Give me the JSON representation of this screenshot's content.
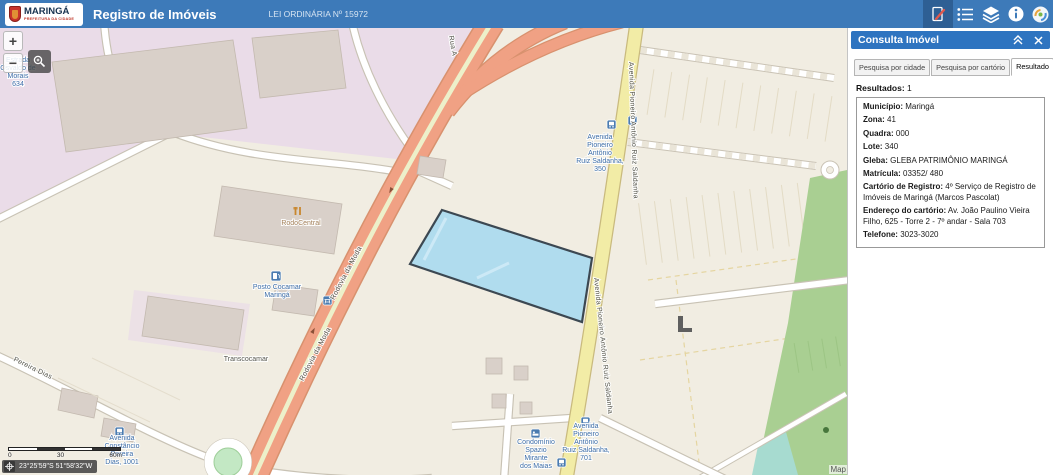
{
  "colors": {
    "header_bg": "#3d7ab9",
    "header_active_bg": "#2e5f94",
    "panel_header_bg": "#2e74c0",
    "map_land": "#f1ede2",
    "industrial_area": "#eadce8",
    "building": "#d9d0c9",
    "road_primary_orange": "#f0a184",
    "road_secondary_yellow": "#f2eca6",
    "green_area": "#a9cf92",
    "water": "#a7dbd0",
    "parcel_fill": "#a5d8f0",
    "parcel_stroke": "#3c4852",
    "poi_label_blue": "#3d6da8"
  },
  "header": {
    "logo": {
      "title": "MARINGÁ",
      "subtitle": "PREFEITURA DA CIDADE"
    },
    "title": "Registro de Imóveis",
    "law": "LEI ORDINÁRIA Nº 15972"
  },
  "panel": {
    "title": "Consulta Imóvel",
    "tabs": [
      {
        "label": "Pesquisa por cidade",
        "active": false
      },
      {
        "label": "Pesquisa por cartório",
        "active": false
      },
      {
        "label": "Resultado",
        "active": true
      }
    ],
    "results_label": "Resultados:",
    "results_count": "1",
    "fields": [
      {
        "label": "Município:",
        "value": "Maringá"
      },
      {
        "label": "Zona:",
        "value": "41"
      },
      {
        "label": "Quadra:",
        "value": "000"
      },
      {
        "label": "Lote:",
        "value": "340"
      },
      {
        "label": "Gleba:",
        "value": "GLEBA PATRIMÔNIO MARINGÁ"
      },
      {
        "label": "Matrícula:",
        "value": "03352/ 480"
      },
      {
        "label": "Cartório de Registro:",
        "value": "4º Serviço de Registro de Imóveis de Maringá (Marcos Pascolat)"
      },
      {
        "label": "Endereço do cartório:",
        "value": "Av. João Paulino Vieira Filho, 625 - Torre 2 - 7º andar - Sala 703"
      },
      {
        "label": "Telefone:",
        "value": "3023-3020"
      }
    ]
  },
  "map": {
    "controls": {
      "zoom_in": "+",
      "zoom_out": "−"
    },
    "scalebar": {
      "start": "0",
      "mid": "30",
      "end": "60m"
    },
    "coordinates": "23°25'59\"S 51°58'32\"W",
    "attribution": "Map",
    "labels": {
      "estrada": [
        "Estrada",
        "Osvaldo de",
        "Morais",
        "634"
      ],
      "rodocentral": "RodoCentral",
      "posto": [
        "Posto Cocamar",
        "Maringá"
      ],
      "transcocamar": "Transcocamar",
      "rodovia_moda": "Rodovia da Moda",
      "pereira_dias": "Pereira Dias",
      "rua_a": "Rua A",
      "av_saldanha": "Avenida Pioneiro Antônio Ruiz Saldanha",
      "av_350": [
        "Avenida",
        "Pioneiro",
        "Antônio",
        "Ruiz Saldanha,",
        "350"
      ],
      "av_701": [
        "Avenida",
        "Pioneiro",
        "Antônio",
        "Ruiz Saldanha,",
        "701"
      ],
      "condominio": [
        "Condomínio",
        "Spazio",
        "Mirante",
        "dos Maias"
      ],
      "constancio": [
        "Avenida",
        "Constâncio",
        "Pereira",
        "Dias, 1001"
      ]
    }
  }
}
